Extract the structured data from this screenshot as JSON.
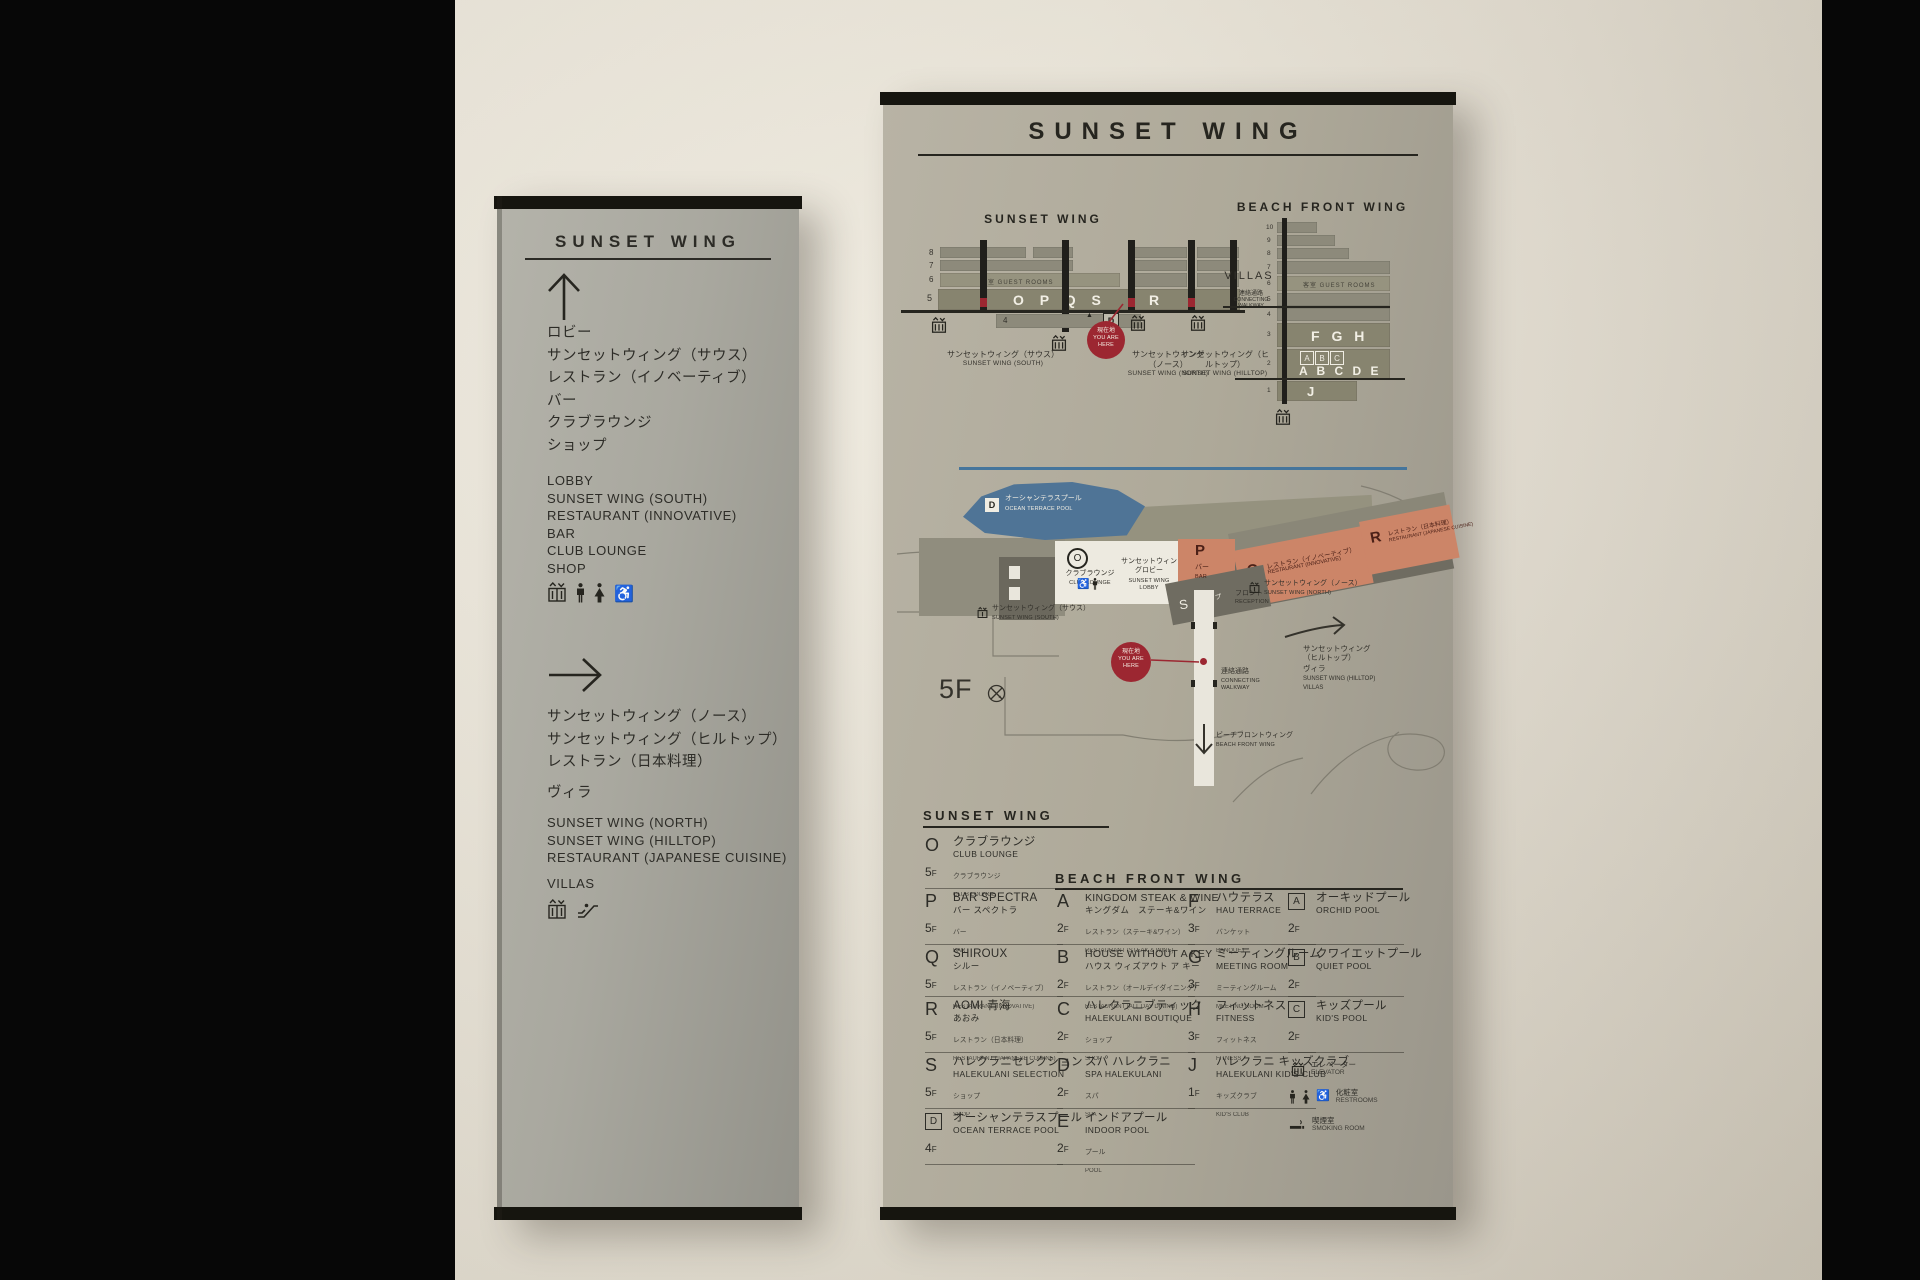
{
  "colors": {
    "accent_red": "#9c2731",
    "salmon": "#cc8568",
    "pool_blue": "#4f7496",
    "divider_blue": "#45759c",
    "panel_gray": "#aea999"
  },
  "left_panel": {
    "title": "SUNSET WING",
    "sec1_jp": [
      "ロビー",
      "サンセットウィング（サウス）",
      "レストラン（イノベーティブ）",
      "バー",
      "クラブラウンジ",
      "ショップ"
    ],
    "sec1_en": [
      "LOBBY",
      "SUNSET WING (SOUTH)",
      "RESTAURANT (INNOVATIVE)",
      "BAR",
      "CLUB LOUNGE",
      "SHOP"
    ],
    "sec2_jp": [
      "サンセットウィング（ノース）",
      "サンセットウィング（ヒルトップ）",
      "レストラン（日本料理）"
    ],
    "sec2_jp_extra": "ヴィラ",
    "sec2_en": [
      "SUNSET WING (NORTH)",
      "SUNSET WING (HILLTOP)",
      "RESTAURANT (JAPANESE CUISINE)"
    ],
    "sec2_en_extra": "VILLAS"
  },
  "right_panel": {
    "title": "SUNSET WING",
    "elev": {
      "sw_title": "SUNSET WING",
      "bfw_title": "BEACH FRONT WING",
      "floors": [
        "8",
        "7",
        "6",
        "5"
      ],
      "floor4": "4",
      "guest": "客室  GUEST ROOMS",
      "opqs": "O P Q S",
      "r": "R",
      "d": "D",
      "pointer": "▲",
      "yah_jp": "現在地",
      "yah_en1": "YOU ARE",
      "yah_en2": "HERE",
      "south_jp": "サンセットウィング（サウス）",
      "south_en": "SUNSET WING (SOUTH)",
      "north_jp": "サンセットウィング（ノース）",
      "north_en": "SUNSET WING (NORTH)",
      "hill_jp": "サンセットウィング（ヒルトップ）",
      "hill_en": "SUNSET WING (HILLTOP)",
      "villas": "VILLAS",
      "conn_jp": "連絡通路",
      "conn_en": "CONNECTING WALKWAY",
      "bfw_floors": [
        "10",
        "9",
        "8",
        "7",
        "6",
        "5",
        "4",
        "3",
        "2",
        "1"
      ],
      "fgh": "F G H",
      "abc": [
        "A",
        "B",
        "C"
      ],
      "abcde": "A B C D E",
      "j": "J"
    },
    "map": {
      "pool_letter": "D",
      "pool_jp": "オーシャンテラスプール",
      "pool_en": "OCEAN TERRACE POOL",
      "o": "O",
      "club_jp": "クラブラウンジ",
      "club_en": "CLUB LOUNGE",
      "lobby_jp": "サンセットウィングロビー",
      "lobby_en": "SUNSET WING LOBBY",
      "p": "P",
      "bar_jp": "バー",
      "bar_en": "BAR",
      "q": "Q",
      "q_jp": "レストラン（イノベーティブ）",
      "q_en": "RESTAURANT (INNOVATIVE)",
      "r": "R",
      "r_jp": "レストラン（日本料理）",
      "r_en": "RESTAURANT (JAPANESE CUISINE)",
      "s": "S",
      "s_jp": "ショップ",
      "s_en": "SHOP",
      "front_jp": "フロント",
      "front_en": "RECEPTION",
      "south_jp": "サンセットウィング（サウス）",
      "south_en": "SUNSET WING (SOUTH)",
      "north_jp": "サンセットウィング（ノース）",
      "north_en": "SUNSET WING (NORTH)",
      "hill_jp": "サンセットウィング（ヒルトップ）",
      "hill_jp2": "ヴィラ",
      "hill_en": "SUNSET WING (HILLTOP)",
      "hill_en2": "VILLAS",
      "yah_jp": "現在地",
      "yah_en1": "YOU ARE",
      "yah_en2": "HERE",
      "conn_jp": "連絡通路",
      "conn_en": "CONNECTING WALKWAY",
      "bfw_jp": "ビーチフロントウィング",
      "bfw_en": "BEACH FRONT WING",
      "floor": "5F"
    },
    "directory": {
      "sw_title": "SUNSET WING",
      "bfw_title": "BEACH FRONT WING",
      "fsuf": "F",
      "col1": [
        {
          "letter": "O",
          "l1": "クラブラウンジ",
          "l2": "CLUB LOUNGE",
          "floor": "5",
          "s1": "クラブラウンジ",
          "s2": "CLUB LOUNGE"
        },
        {
          "letter": "P",
          "l1": "BAR SPECTRA",
          "l2": "バー スペクトラ",
          "floor": "5",
          "s1": "バー",
          "s2": "BAR"
        },
        {
          "letter": "Q",
          "l1": "SHIROUX",
          "l2": "シルー",
          "floor": "5",
          "s1": "レストラン（イノベーティブ）",
          "s2": "RESTAURANT (INNOVATIVE)"
        },
        {
          "letter": "R",
          "l1": "AOMI 青海",
          "l2": "あおみ",
          "floor": "5",
          "s1": "レストラン（日本料理）",
          "s2": "RESTAURANT (JAPANESE CUISINE)"
        },
        {
          "letter": "S",
          "l1": "ハレクラニセレクション",
          "l2": "HALEKULANI SELECTION",
          "floor": "5",
          "s1": "ショップ",
          "s2": "SHOP"
        },
        {
          "letter": "D",
          "l1": "オーシャンテラスプール",
          "l2": "OCEAN TERRACE POOL",
          "floor": "4",
          "s1": "",
          "s2": ""
        }
      ],
      "col2": [
        {
          "letter": "A",
          "l1": "KINGDOM STEAK & WINE",
          "l2": "キングダム　ステーキ&ワイン",
          "floor": "2",
          "s1": "レストラン（ステーキ&ワイン）",
          "s2": "RESTAURANT (STEAK & WINE)"
        },
        {
          "letter": "B",
          "l1": "HOUSE WITHOUT A KEY",
          "l2": "ハウス ウィズアウト ア キー",
          "floor": "2",
          "s1": "レストラン（オールデイダイニング）",
          "s2": "RESTAURANT (ALL DAY DINING)"
        },
        {
          "letter": "C",
          "l1": "ハレクラニブティック",
          "l2": "HALEKULANI BOUTIQUE",
          "floor": "2",
          "s1": "ショップ",
          "s2": "SHOP"
        },
        {
          "letter": "D",
          "l1": "スパ ハレクラニ",
          "l2": "SPA HALEKULANI",
          "floor": "2",
          "s1": "スパ",
          "s2": "SPA"
        },
        {
          "letter": "E",
          "l1": "インドアプール",
          "l2": "INDOOR POOL",
          "floor": "2",
          "s1": "プール",
          "s2": "POOL"
        }
      ],
      "col3": [
        {
          "letter": "F",
          "l1": "ハウテラス",
          "l2": "HAU TERRACE",
          "floor": "3",
          "s1": "バンケット",
          "s2": "BANQUET"
        },
        {
          "letter": "G",
          "l1": "ミーティングルーム",
          "l2": "MEETING ROOM",
          "floor": "3",
          "s1": "ミーティングルーム",
          "s2": "MEETING ROOM"
        },
        {
          "letter": "H",
          "l1": "フィットネス",
          "l2": "FITNESS",
          "floor": "3",
          "s1": "フィットネス",
          "s2": "FITNESS"
        },
        {
          "letter": "J",
          "l1": "ハレクラニ キッズクラブ",
          "l2": "HALEKULANI KID'S CLUB",
          "floor": "1",
          "s1": "キッズクラブ",
          "s2": "KID'S CLUB"
        }
      ],
      "col4": [
        {
          "letter": "A",
          "l1": "オーキッドプール",
          "l2": "ORCHID POOL",
          "floor": "2",
          "s1": "",
          "s2": ""
        },
        {
          "letter": "B",
          "l1": "クワイエットプール",
          "l2": "QUIET POOL",
          "floor": "2",
          "s1": "",
          "s2": ""
        },
        {
          "letter": "C",
          "l1": "キッズプール",
          "l2": "KID'S POOL",
          "floor": "2",
          "s1": "",
          "s2": ""
        }
      ],
      "legend": [
        {
          "jp": "エレベーター",
          "en": "ELEVATOR"
        },
        {
          "jp": "化粧室",
          "en": "RESTROOMS"
        },
        {
          "jp": "喫煙室",
          "en": "SMOKING ROOM"
        }
      ]
    }
  }
}
